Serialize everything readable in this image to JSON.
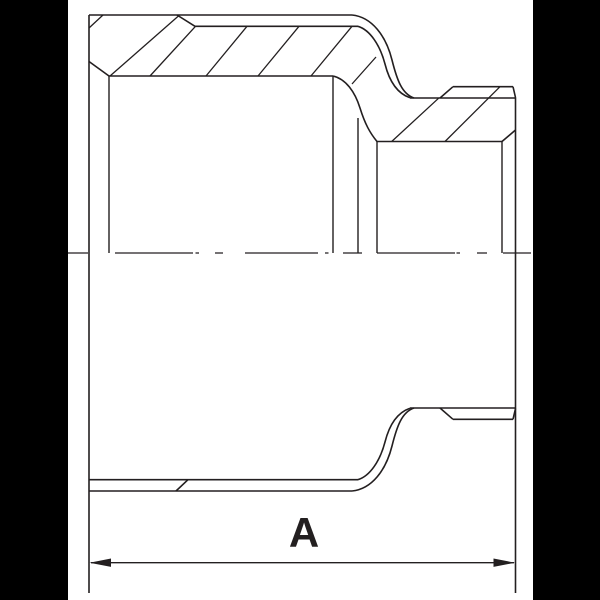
{
  "dimension": {
    "label": "A"
  },
  "drawing": {
    "ink": "#231f20",
    "background": "#ffffff",
    "letterbox_color": "#000000",
    "canvas": {
      "x": 67.5,
      "width": 465,
      "height": 600
    },
    "label_style": {
      "x": 304,
      "y": 512,
      "font_size": 42
    },
    "groups": [
      {
        "id": "g-outline",
        "name": "part-outline",
        "width": 1.6,
        "paths": [
          "M89,15 V593",
          "M89,15 H352",
          "M177,15 L195,26.3",
          "M195,26.3 H358",
          "M352,15 C372,17 386,36 392,60 C397,80 402,94 414,98",
          "M358,26.3 C370,30 380,45 385,64 C389,80 396,93 410,97.8",
          "M410,98 H515.5",
          "M440,98 L453,86.7",
          "M453,86.7 H513",
          "M513,86.7 L515.5,97.5",
          "M515.5,97.5 V593",
          "M89,61.5 L109,76",
          "M109,76 H333",
          "M333,76 C346,79 355,92 360,108 C365,124 370,133 377,141.5",
          "M377,141.5 H502",
          "M502,141.5 L515.5,130",
          "M89,491 H352",
          "M89,479.7 H358",
          "M176,491 L188,479.7",
          "M352,491 C372,489 386,470 392,446 C397,426 402,412 414,408",
          "M358,479.7 C370,476 380,461 385,442 C389,426 396,413 410,408.2",
          "M410,408 H515.5",
          "M440,408 L453,419.3",
          "M453,419.3 H513",
          "M513,419.3 L515.5,408.5"
        ]
      },
      {
        "id": "g-projection",
        "name": "edge-projection-lines",
        "width": 1.4,
        "paths": [
          "M109,76 V253",
          "M333,76 V253",
          "M358,118 V253",
          "M377,141.5 V253",
          "M502,141.5 V253"
        ]
      },
      {
        "id": "g-hatch",
        "name": "section-hatching",
        "width": 1.3,
        "paths": [
          "M89,28 L103,15",
          "M110,76 L179,15.5",
          "M150,76 L195.5,26.3",
          "M206,76 L247,26.3",
          "M258,76 L299,26.3",
          "M311,76 L352,26.3",
          "M352,84 L376,57",
          "M391.7,141.5 L438.5,98.3",
          "M445,141.5 L500,86.7"
        ]
      },
      {
        "id": "g-centerline",
        "name": "centerline",
        "width": 1.2,
        "paths": [
          "M68,253 H88 M115,253 H193 M195.5,253 H199 M215,253 H223 M245,253 H318 M325,253 H328.5 M343,253 H362 M377,253 H455 M456.5,253 H460 M477,253 H487 M503,253 H531"
        ]
      },
      {
        "id": "g-dimension",
        "name": "dimension-line",
        "width": 1.3,
        "paths": [
          "M91,562.7 H514"
        ],
        "polygons": [
          "89.5,562.7 111,558.5 111,566.9",
          "515,562.7 493.5,558.5 493.5,566.9"
        ]
      }
    ]
  }
}
